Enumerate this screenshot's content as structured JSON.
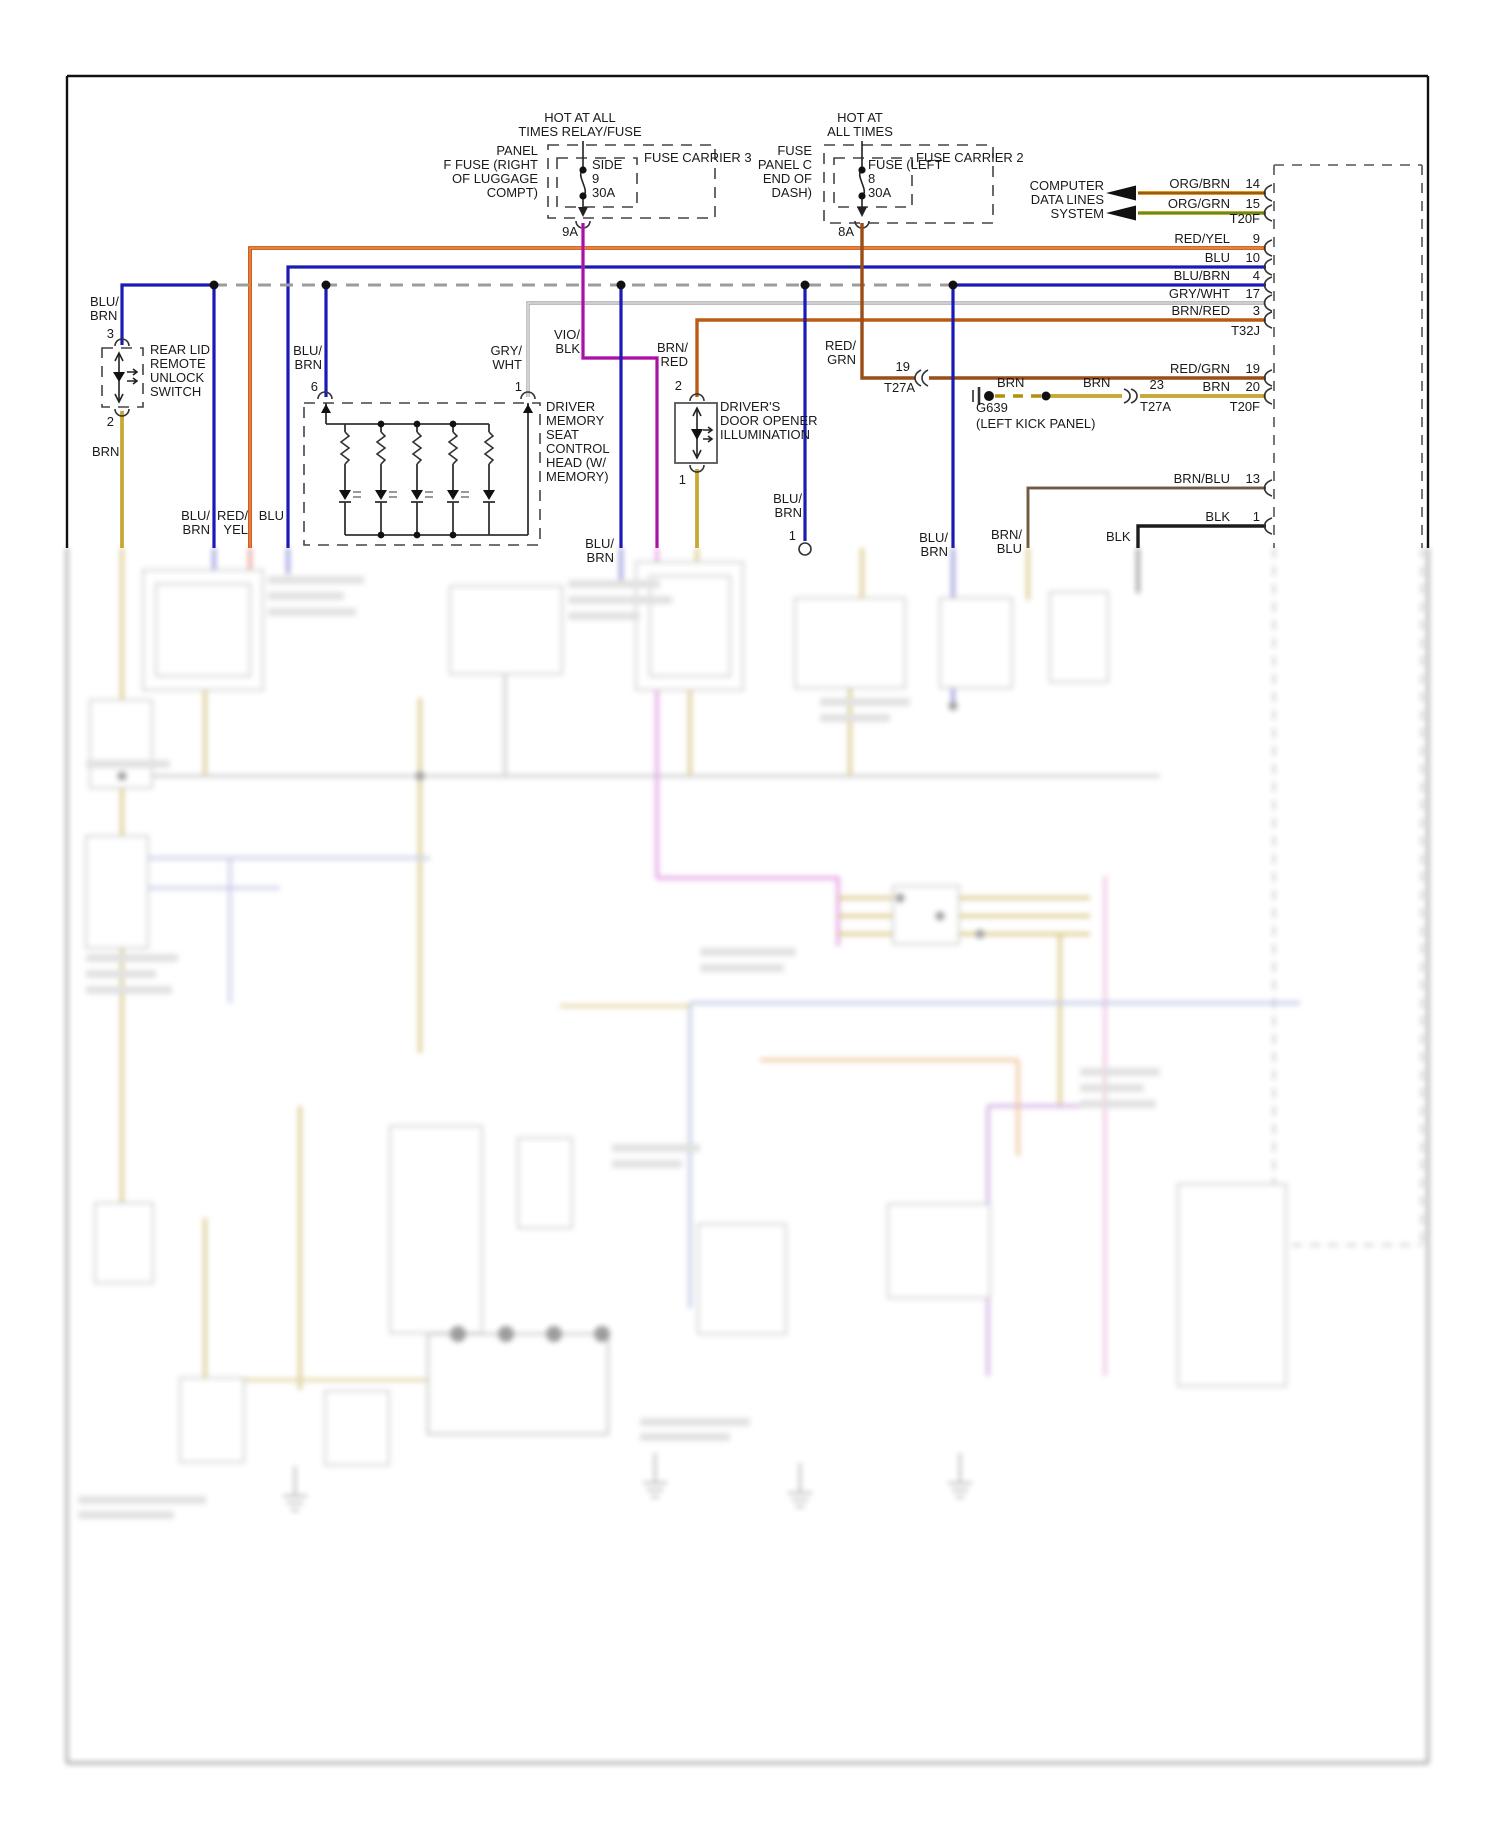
{
  "fuse_carrier_3": {
    "hot_label": "HOT AT ALL\nTIMES RELAY/FUSE",
    "panel_label": "PANEL\nF FUSE (RIGHT\nOF LUGGAGE\nCOMPT)",
    "carrier_label": "FUSE CARRIER 3",
    "fuse_label": "SIDE\n9\n30A",
    "output_label": "9A"
  },
  "fuse_carrier_2": {
    "hot_label": "HOT AT\nALL TIMES",
    "panel_label": "FUSE\nPANEL C\nEND OF\nDASH)",
    "carrier_label": "FUSE CARRIER 2",
    "fuse_label": "FUSE (LEFT\n8\n30A",
    "output_label": "8A"
  },
  "computer_data_lines": {
    "label": "COMPUTER\nDATA LINES\nSYSTEM"
  },
  "right_connector": {
    "pins": [
      {
        "wire": "ORG/BRN",
        "pin": "14"
      },
      {
        "wire": "ORG/GRN",
        "pin": "15"
      },
      {
        "wire": "RED/YEL",
        "pin": "9"
      },
      {
        "wire": "BLU",
        "pin": "10"
      },
      {
        "wire": "BLU/BRN",
        "pin": "4"
      },
      {
        "wire": "GRY/WHT",
        "pin": "17"
      },
      {
        "wire": "BRN/RED",
        "pin": "3"
      },
      {
        "wire": "RED/GRN",
        "pin": "19"
      },
      {
        "wire": "BRN",
        "pin": "20"
      },
      {
        "wire": "BRN/BLU",
        "pin": "13"
      },
      {
        "wire": "BLK",
        "pin": "1"
      }
    ],
    "t20f_top": "T20F",
    "t32j": "T32J",
    "t20f_mid": "T20F"
  },
  "inline_connectors": {
    "t27a_19": {
      "pin": "19",
      "label": "T27A"
    },
    "t27a_23": {
      "pin": "23",
      "label": "T27A"
    }
  },
  "ground": {
    "wire_left": "BRN",
    "wire_right": "BRN",
    "id": "G639",
    "location": "(LEFT KICK PANEL)"
  },
  "rear_lid_switch": {
    "wire_top": "BLU/\nBRN",
    "pin_top": "3",
    "name": "REAR LID\nREMOTE\nUNLOCK\nSWITCH",
    "pin_bottom": "2",
    "wire_bottom": "BRN"
  },
  "seat_control_head": {
    "name": "DRIVER\nMEMORY\nSEAT\nCONTROL\nHEAD (W/\nMEMORY)",
    "wire_left": "BLU/\nBRN",
    "pin_left": "6",
    "wire_right": "GRY/\nWHT",
    "pin_right": "1"
  },
  "door_opener": {
    "name": "DRIVER'S\nDOOR OPENER\nILLUMINATION",
    "wire_top": "BRN/\nRED",
    "pin_top": "2",
    "pin_bottom": "1"
  },
  "wire_labels": {
    "vio_blk": "VIO/\nBLK",
    "red_grn": "RED/\nGRN",
    "riser_blubrn_left": "BLU/\nBRN",
    "riser_redyel": "RED/\nYEL",
    "riser_blu": "BLU",
    "riser_blubrn_mid": "BLU/\nBRN",
    "riser_blubrn_door": "BLU/\nBRN",
    "riser_blubrn_door_pin": "1",
    "riser_blubrn_right": "BLU/\nBRN",
    "riser_brnblu": "BRN/\nBLU",
    "riser_blk": "BLK"
  },
  "colors": {
    "red_yel": "#cc2a16",
    "yel": "#e8c820",
    "blu": "#1a1ab4",
    "gry": "#a8a8a8",
    "wht": "#f4f4f4",
    "brn_red": "#bc5a14",
    "vio": "#c622c2",
    "vio_core": "#7a0a7a",
    "red_grn": "#cc3014",
    "grn": "#3f7f1f",
    "org": "#e8941c",
    "org_core": "#7a4a10",
    "org_grn": "#c0ae2a",
    "grn_core": "#4a7c1c",
    "brn": "#b2900e",
    "brn_core": "#e2c248",
    "brn_blu": "#bfa23e",
    "brn_blu_core": "#2828a8",
    "blk": "#1c1c1c",
    "dash_gry": "#9c9c9c"
  }
}
